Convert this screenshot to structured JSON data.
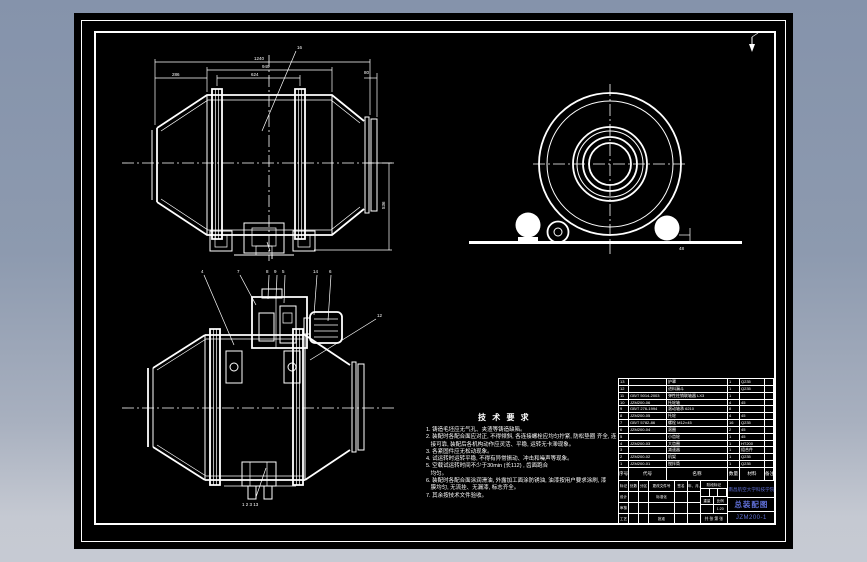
{
  "window": {
    "background_top": "#8593ab",
    "background_bottom": "#c6cad3",
    "canvas_color": "#000000",
    "line_color": "#ffffff",
    "accent_blue": "#5f6fd6"
  },
  "tech_requirements": {
    "title": "技 术 要 求",
    "lines": [
      "1. 铸造毛坯应无气孔、夹渣等铸造缺陷。",
      "2. 装配时各配合面应对正, 不得倾斜, 各连接螺栓应均匀拧紧, 防松垫圈 齐全, 连",
      "   接可靠, 装配后各机构动作应灵活、平稳, 运转无卡滞现象。",
      "3. 各紧固件应无松动现象。",
      "4. 试运转时运转平稳, 不得有异常振动、冲击和噪声等现象。",
      "5. 空载试运转时间不少于30min (长112) , 齿面跑合",
      "   均匀。",
      "6. 装配时各配合面涂润滑油, 外露加工面涂防锈油, 油漆按用户要求涂刷, 漆",
      "   膜均匀, 无流挂、无漏漆, 标志齐全。",
      "7. 其余按技术文件验收。"
    ]
  },
  "bom": {
    "headers": [
      "序号",
      "代号",
      "名称",
      "数量",
      "材料",
      "备注"
    ],
    "rows": [
      [
        "13",
        "",
        "护罩",
        "1",
        "Q235",
        ""
      ],
      [
        "12",
        "",
        "进料漏斗",
        "1",
        "Q235",
        ""
      ],
      [
        "11",
        "GB/T 5014-2003",
        "弹性柱销联轴器 LX3",
        "1",
        "",
        ""
      ],
      [
        "10",
        "JZM200-06",
        "托轮轴",
        "4",
        "45",
        ""
      ],
      [
        "9",
        "GB/T 276-1994",
        "滚动轴承 6210",
        "8",
        "",
        ""
      ],
      [
        "8",
        "JZM200-05",
        "托轮",
        "4",
        "45",
        ""
      ],
      [
        "7",
        "GB/T 5782-86",
        "螺栓 M12×45",
        "16",
        "Q235",
        ""
      ],
      [
        "6",
        "JZM200-04",
        "滚圈",
        "2",
        "45",
        ""
      ],
      [
        "5",
        "",
        "小齿轮",
        "1",
        "45",
        ""
      ],
      [
        "4",
        "JZM200-03",
        "大齿圈",
        "1",
        "HT200",
        ""
      ],
      [
        "3",
        "",
        "减速器",
        "1",
        "组合件",
        ""
      ],
      [
        "2",
        "JZM200-02",
        "机架",
        "1",
        "Q235",
        ""
      ],
      [
        "1",
        "JZM200-01",
        "搅拌筒",
        "1",
        "Q235",
        ""
      ]
    ]
  },
  "title_block": {
    "revision_headers": [
      "标记",
      "处数",
      "分区",
      "更改文件号",
      "签名",
      "年、月、日"
    ],
    "role_rows": [
      [
        "设计",
        "",
        "",
        "标准化",
        "",
        ""
      ],
      [
        "审核",
        "",
        "",
        "",
        "",
        ""
      ],
      [
        "工艺",
        "",
        "",
        "批准",
        "",
        ""
      ]
    ],
    "stage_label": "阶段标记",
    "weight_label": "重量",
    "scale_label": "比例",
    "scale_value": "1:20",
    "sheets_label": "共 张 第 张",
    "company": "南昌航空大学科技学院",
    "drawing_title": "总装配图",
    "drawing_number": "JZM200-1"
  },
  "views": {
    "side_view": {
      "leader_label": "16",
      "section_label": "Ⅱ",
      "dim_overall": "1240",
      "dim_mid": "940",
      "dim_band": "624",
      "dim_left": "286",
      "dim_right": "80",
      "dim_height": "536"
    },
    "end_view": {
      "dim_roller": "48"
    },
    "drive_view": {
      "c1": "4",
      "c2": "7",
      "c3": "8",
      "c4": "9",
      "c5": "5",
      "c6": "14",
      "c7": "6",
      "c_right": "12",
      "c_bottom": "1 2 3 13"
    }
  }
}
